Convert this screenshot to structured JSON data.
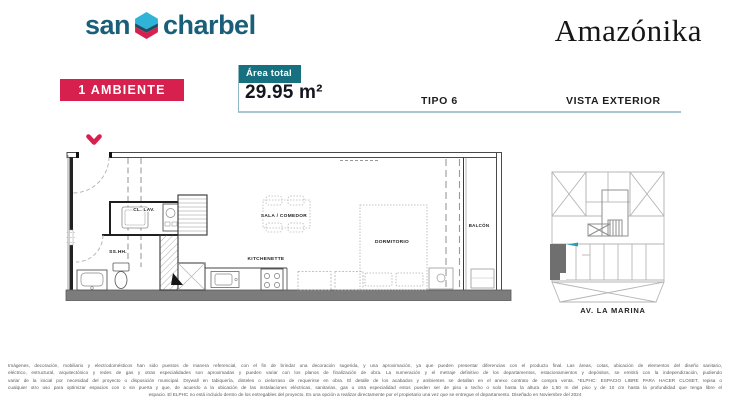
{
  "brand": {
    "word1": "san",
    "word2": "charbel"
  },
  "project": {
    "name": "Amazónika"
  },
  "header": {
    "ambiente": "1 AMBIENTE",
    "area_label": "Área total",
    "area_value": "29.95 m²",
    "tipo": "TIPO 6",
    "vista": "VISTA EXTERIOR"
  },
  "floorplan": {
    "label_cl_lav": "CL. LAV.",
    "label_sshh": "SS.HH.",
    "label_kitchenette": "KITCHENETTE",
    "label_sala": "SALA / COMEDOR",
    "label_dormitorio": "DORMITORIO",
    "label_balcon": "BALCÓN"
  },
  "map": {
    "street": "AV.  LA MARINA"
  },
  "footer": {
    "lines": [
      "Imágenes, decoración, mobiliario y electrodomésticos han sido puestos de manera referencial, con el fin de brindar una decoración sugerida, y una aproximación, ya que pueden presentar diferencias con el producto final. Las áreas, cotas, ubicación de elementos del diseño sanitario,",
      "eléctrico, estructural, arquitectónico y redes de gas y otras especialidades son aproximadas y pueden variar con los planos de finalización de obra. La numeración y el metraje definitivo de los departamentos, estacionamientos y depósitos, se emitirá con la independización, pudiendo",
      "variar de la inicial por necesidad del proyecto o disposición municipal. Drywall en tabiquería, dinteles o cielorraso de requerirse en obra. El detalle de los acabados y ambientes se detallan en el anexo contrato de compra venta. *ELPHC: ESPACIO LIBRE PARA HACER CLOSET, repisa o",
      "cualquier otro uso para optimizar espacios con o sin puerta y que, de acuerdo a la ubicación de las instalaciones eléctricas, sanitarias, gas u otra especialidad estos pueden ser de piso a techo o solo hasta la altura de 1,50 m del piso y de 10 cm hasta la profundidad que tenga libre el",
      "espacio. El ELPHC no está incluido dentro de los entregables del proyecto. Es una opción a realizar directamente por el propietario una vez que se entregue el departamento. Diseñado en Noviembre del 2024"
    ]
  },
  "colors": {
    "brand_blue": "#1a5f7a",
    "accent_red": "#d7204d",
    "accent_teal": "#16707f",
    "hexagon_cyan": "#2fb4d8",
    "hexagon_dark": "#1d4e66",
    "rule_blue": "#a9c7d3"
  }
}
